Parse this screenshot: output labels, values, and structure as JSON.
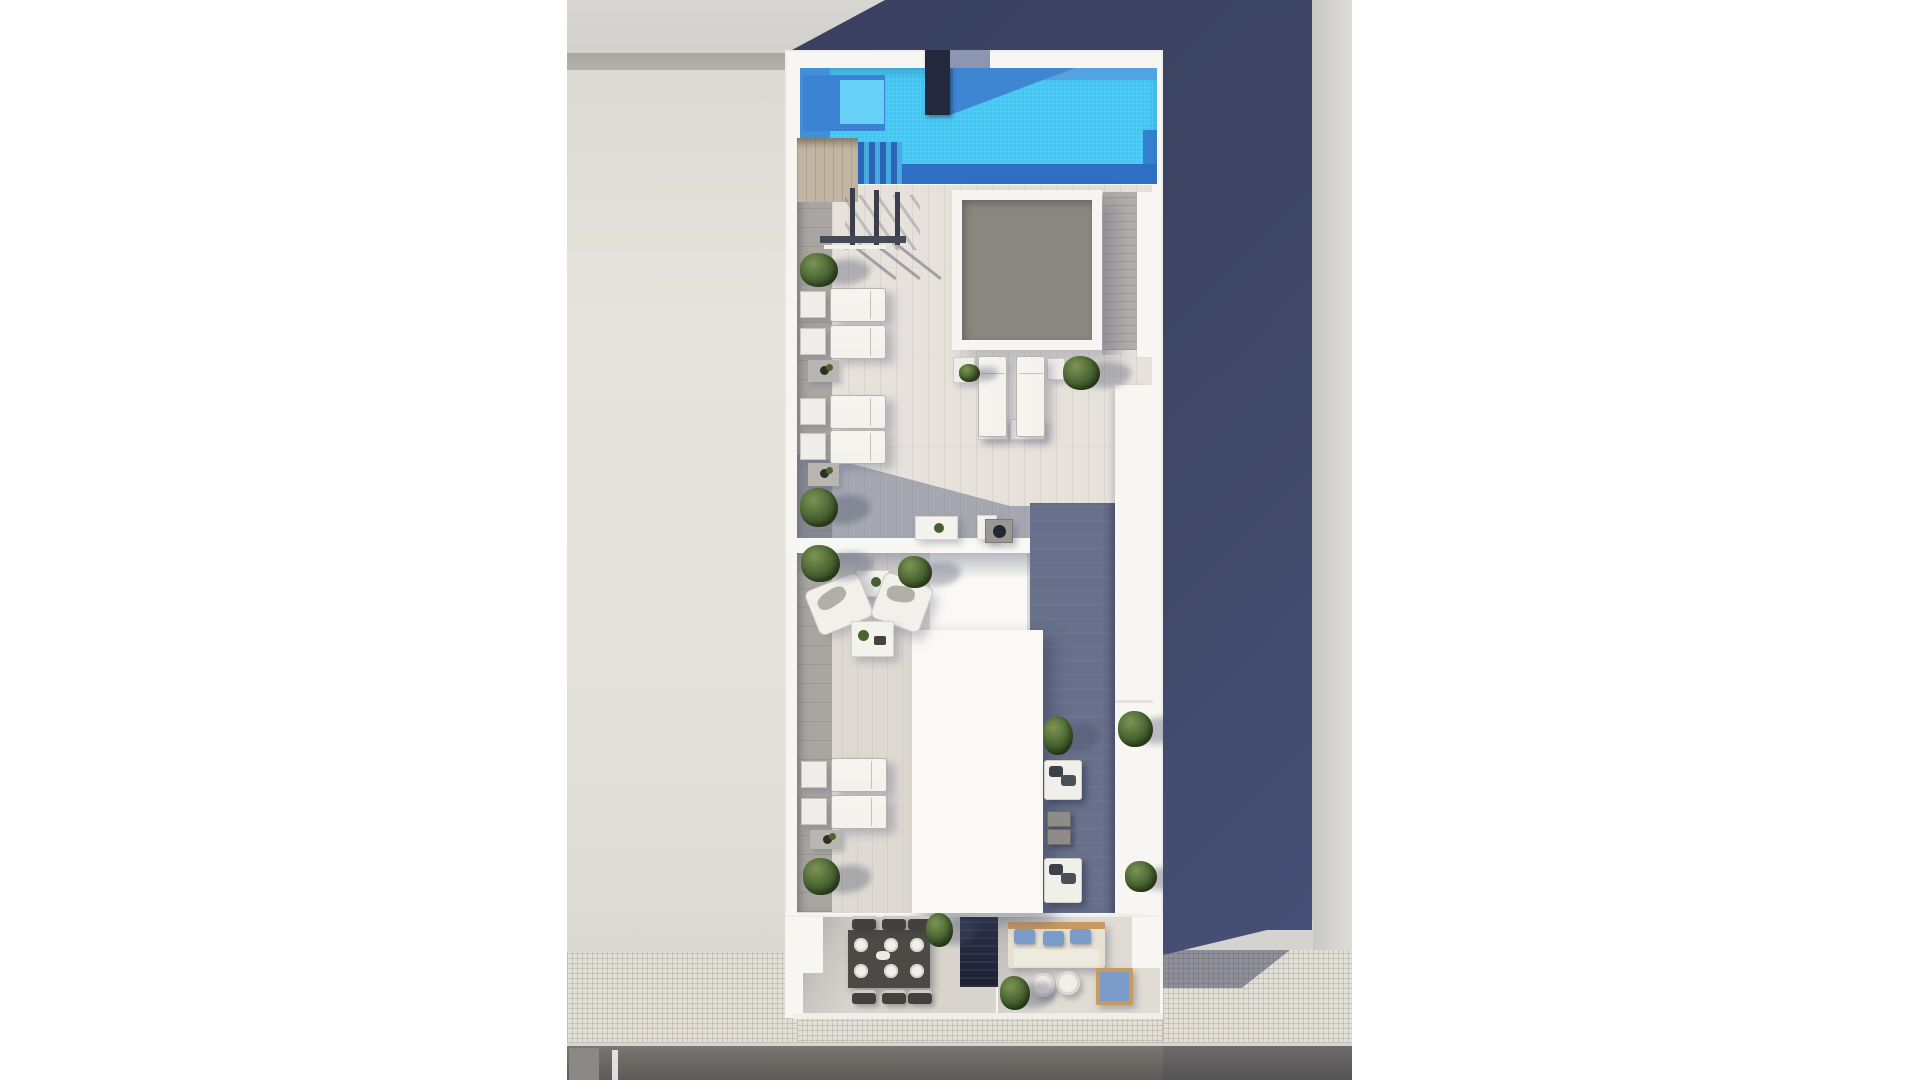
{
  "meta": {
    "title": "Aerial 3D architectural render: rooftop penthouse terraces with swimming pool, sun loungers, skylight, lounge seating and street-front balconies",
    "render_type": "top-down architectural visualization",
    "visible_text": "none"
  },
  "colors": {
    "page_bg": "#ffffff",
    "neighbor_wall": "#e3e0da",
    "band_gray": "#a9a6a2",
    "ceiling_gray": "#d2d0cc",
    "navy_shadow": "#3e4564",
    "right_wall": "#d5d3cf",
    "plan_white": "#f7f6f2",
    "pool_bright": "#44c6f2",
    "pool_mid": "#4090d8",
    "pool_dark": "#2e6fc4",
    "pool_inner": "#68d1f8",
    "column_dark": "#23283c",
    "column_cap": "#8c95b2",
    "deck_tan": "#c2b5a3",
    "deck_gray": "#a9a5a1",
    "tile_light": "#e6e2db",
    "tile_t2": "#dedad3",
    "skylight_gray": "#8a8781",
    "skylight_frame": "#f6f5f1",
    "slat_gray": "#b2aeaa",
    "corridor_dark": "#68708b",
    "divider_white": "#f8f7f3",
    "roof_white": "#faf9f5",
    "post_dark": "#3c3f4a",
    "tree_dark": "#2c4019",
    "tree_mid": "#55703a",
    "tree_light": "#7d9355",
    "lounger_pad": "#f4f2ed",
    "lounger_border": "#b7b4ae",
    "table_white": "#efede8",
    "mat_gray": "#b9b5b0",
    "room_left_floor": "#d9d5ce",
    "room_right_floor": "#e0dcd4",
    "dining_table": "#4b4a46",
    "chair_dark": "#42413d",
    "plate": "#f2f0ea",
    "stairwell": "#1d2133",
    "sofa_base": "#e7e1d4",
    "sofa_wood": "#c89a62",
    "pillow_blue": "#7b9cc9",
    "sidewalk": "#e2dfd7",
    "curb": "#d9d6cf",
    "road": "#6e6a66",
    "grill": "#9b9894",
    "grill_dark": "#23272f"
  },
  "regions": [
    {
      "id": "swimming-pool",
      "label": "rooftop swimming pool with tiled water, in-pool bench and steps"
    },
    {
      "id": "pool-column",
      "label": "dark structural column at pool edge casting shadow"
    },
    {
      "id": "wood-deck",
      "label": "timber deck strip along left edge"
    },
    {
      "id": "pergola",
      "label": "pergola posts and glass fence at pool deck"
    },
    {
      "id": "skylight",
      "label": "large gray skylight with white frame"
    },
    {
      "id": "upper-terrace",
      "label": "upper terrace with sun loungers, side tables and plants"
    },
    {
      "id": "lower-terrace",
      "label": "second terrace with armchair lounge set and loungers"
    },
    {
      "id": "roof-block",
      "label": "white roof volume of unit below"
    },
    {
      "id": "service-corridor",
      "label": "shadowed side deck with benches and planters"
    },
    {
      "id": "dining-balcony",
      "label": "street-front balcony with dining table for six"
    },
    {
      "id": "lounge-balcony",
      "label": "street-front balcony with sofa, blue cushions and round tables"
    },
    {
      "id": "stairwell-skylight",
      "label": "dark stair skylight between balconies"
    },
    {
      "id": "neighbor-wall",
      "label": "adjacent building wall, left"
    },
    {
      "id": "building-shadow",
      "label": "large navy cast shadow, right"
    },
    {
      "id": "sidewalk",
      "label": "tiled sidewalk"
    },
    {
      "id": "road",
      "label": "asphalt road with lane marking"
    }
  ],
  "items": {
    "trees": [
      {
        "x": 800,
        "y": 253,
        "w": 38,
        "h": 34
      },
      {
        "x": 800,
        "y": 488,
        "w": 38,
        "h": 39
      },
      {
        "x": 801,
        "y": 545,
        "w": 39,
        "h": 37
      },
      {
        "x": 898,
        "y": 556,
        "w": 34,
        "h": 32
      },
      {
        "x": 1063,
        "y": 356,
        "w": 37,
        "h": 34
      },
      {
        "x": 959,
        "y": 364,
        "w": 21,
        "h": 18
      },
      {
        "x": 1043,
        "y": 716,
        "w": 30,
        "h": 39
      },
      {
        "x": 1118,
        "y": 711,
        "w": 35,
        "h": 36
      },
      {
        "x": 1125,
        "y": 861,
        "w": 32,
        "h": 31
      },
      {
        "x": 803,
        "y": 858,
        "w": 37,
        "h": 37
      },
      {
        "x": 926,
        "y": 913,
        "w": 27,
        "h": 34
      },
      {
        "x": 1000,
        "y": 976,
        "w": 30,
        "h": 34
      }
    ],
    "loungers_h": [
      {
        "x": 800,
        "y": 288
      },
      {
        "x": 800,
        "y": 325
      },
      {
        "x": 800,
        "y": 395
      },
      {
        "x": 800,
        "y": 430
      },
      {
        "x": 801,
        "y": 758
      },
      {
        "x": 801,
        "y": 795
      }
    ],
    "loungers_v": [
      {
        "x": 978,
        "y": 356
      },
      {
        "x": 1016,
        "y": 356
      }
    ],
    "white_tables": [
      {
        "x": 953,
        "y": 357,
        "w": 22,
        "h": 26
      },
      {
        "x": 1047,
        "y": 358,
        "w": 18,
        "h": 22
      },
      {
        "x": 978,
        "y": 419,
        "w": 30,
        "h": 21
      },
      {
        "x": 1010,
        "y": 419,
        "w": 35,
        "h": 21
      }
    ],
    "plant_mats": [
      {
        "x": 808,
        "y": 360,
        "w": 31,
        "h": 22
      },
      {
        "x": 808,
        "y": 463,
        "w": 31,
        "h": 23
      },
      {
        "x": 810,
        "y": 830,
        "w": 32,
        "h": 19
      }
    ],
    "plant_tables": [
      {
        "x": 915,
        "y": 516,
        "w": 43,
        "h": 24
      },
      {
        "x": 856,
        "y": 570,
        "w": 33,
        "h": 27
      },
      {
        "x": 977,
        "y": 515,
        "w": 20,
        "h": 25
      }
    ],
    "armchairs": [
      {
        "x": 810,
        "y": 580,
        "w": 58,
        "h": 48,
        "rot": -22
      },
      {
        "x": 876,
        "y": 578,
        "w": 52,
        "h": 49,
        "rot": 20
      }
    ],
    "benches": [
      {
        "x": 1044,
        "y": 760,
        "w": 38,
        "h": 40
      },
      {
        "x": 1044,
        "y": 858,
        "w": 38,
        "h": 45
      }
    ],
    "cube_tables": [
      {
        "x": 1047,
        "y": 811,
        "w": 24,
        "h": 16
      },
      {
        "x": 1047,
        "y": 829,
        "w": 24,
        "h": 16
      }
    ],
    "pergola_posts": [
      {
        "x": 850,
        "y": 188,
        "h": 57
      },
      {
        "x": 874,
        "y": 190,
        "h": 55
      },
      {
        "x": 895,
        "y": 192,
        "h": 53
      }
    ],
    "plates": [
      {
        "x": 854,
        "y": 938
      },
      {
        "x": 884,
        "y": 938
      },
      {
        "x": 910,
        "y": 938
      },
      {
        "x": 854,
        "y": 964
      },
      {
        "x": 884,
        "y": 964
      },
      {
        "x": 910,
        "y": 964
      }
    ],
    "dining_chairs": [
      {
        "x": 852,
        "y": 916
      },
      {
        "x": 882,
        "y": 916
      },
      {
        "x": 908,
        "y": 916
      },
      {
        "x": 852,
        "y": 990
      },
      {
        "x": 882,
        "y": 990
      },
      {
        "x": 908,
        "y": 990
      }
    ],
    "sofa_pillows": [
      {
        "x": 1014,
        "y": 929,
        "w": 21,
        "h": 15
      },
      {
        "x": 1043,
        "y": 931,
        "w": 21,
        "h": 15
      },
      {
        "x": 1070,
        "y": 929,
        "w": 21,
        "h": 15
      }
    ],
    "round_tables": [
      {
        "x": 1031,
        "y": 973
      },
      {
        "x": 1056,
        "y": 971
      }
    ]
  }
}
